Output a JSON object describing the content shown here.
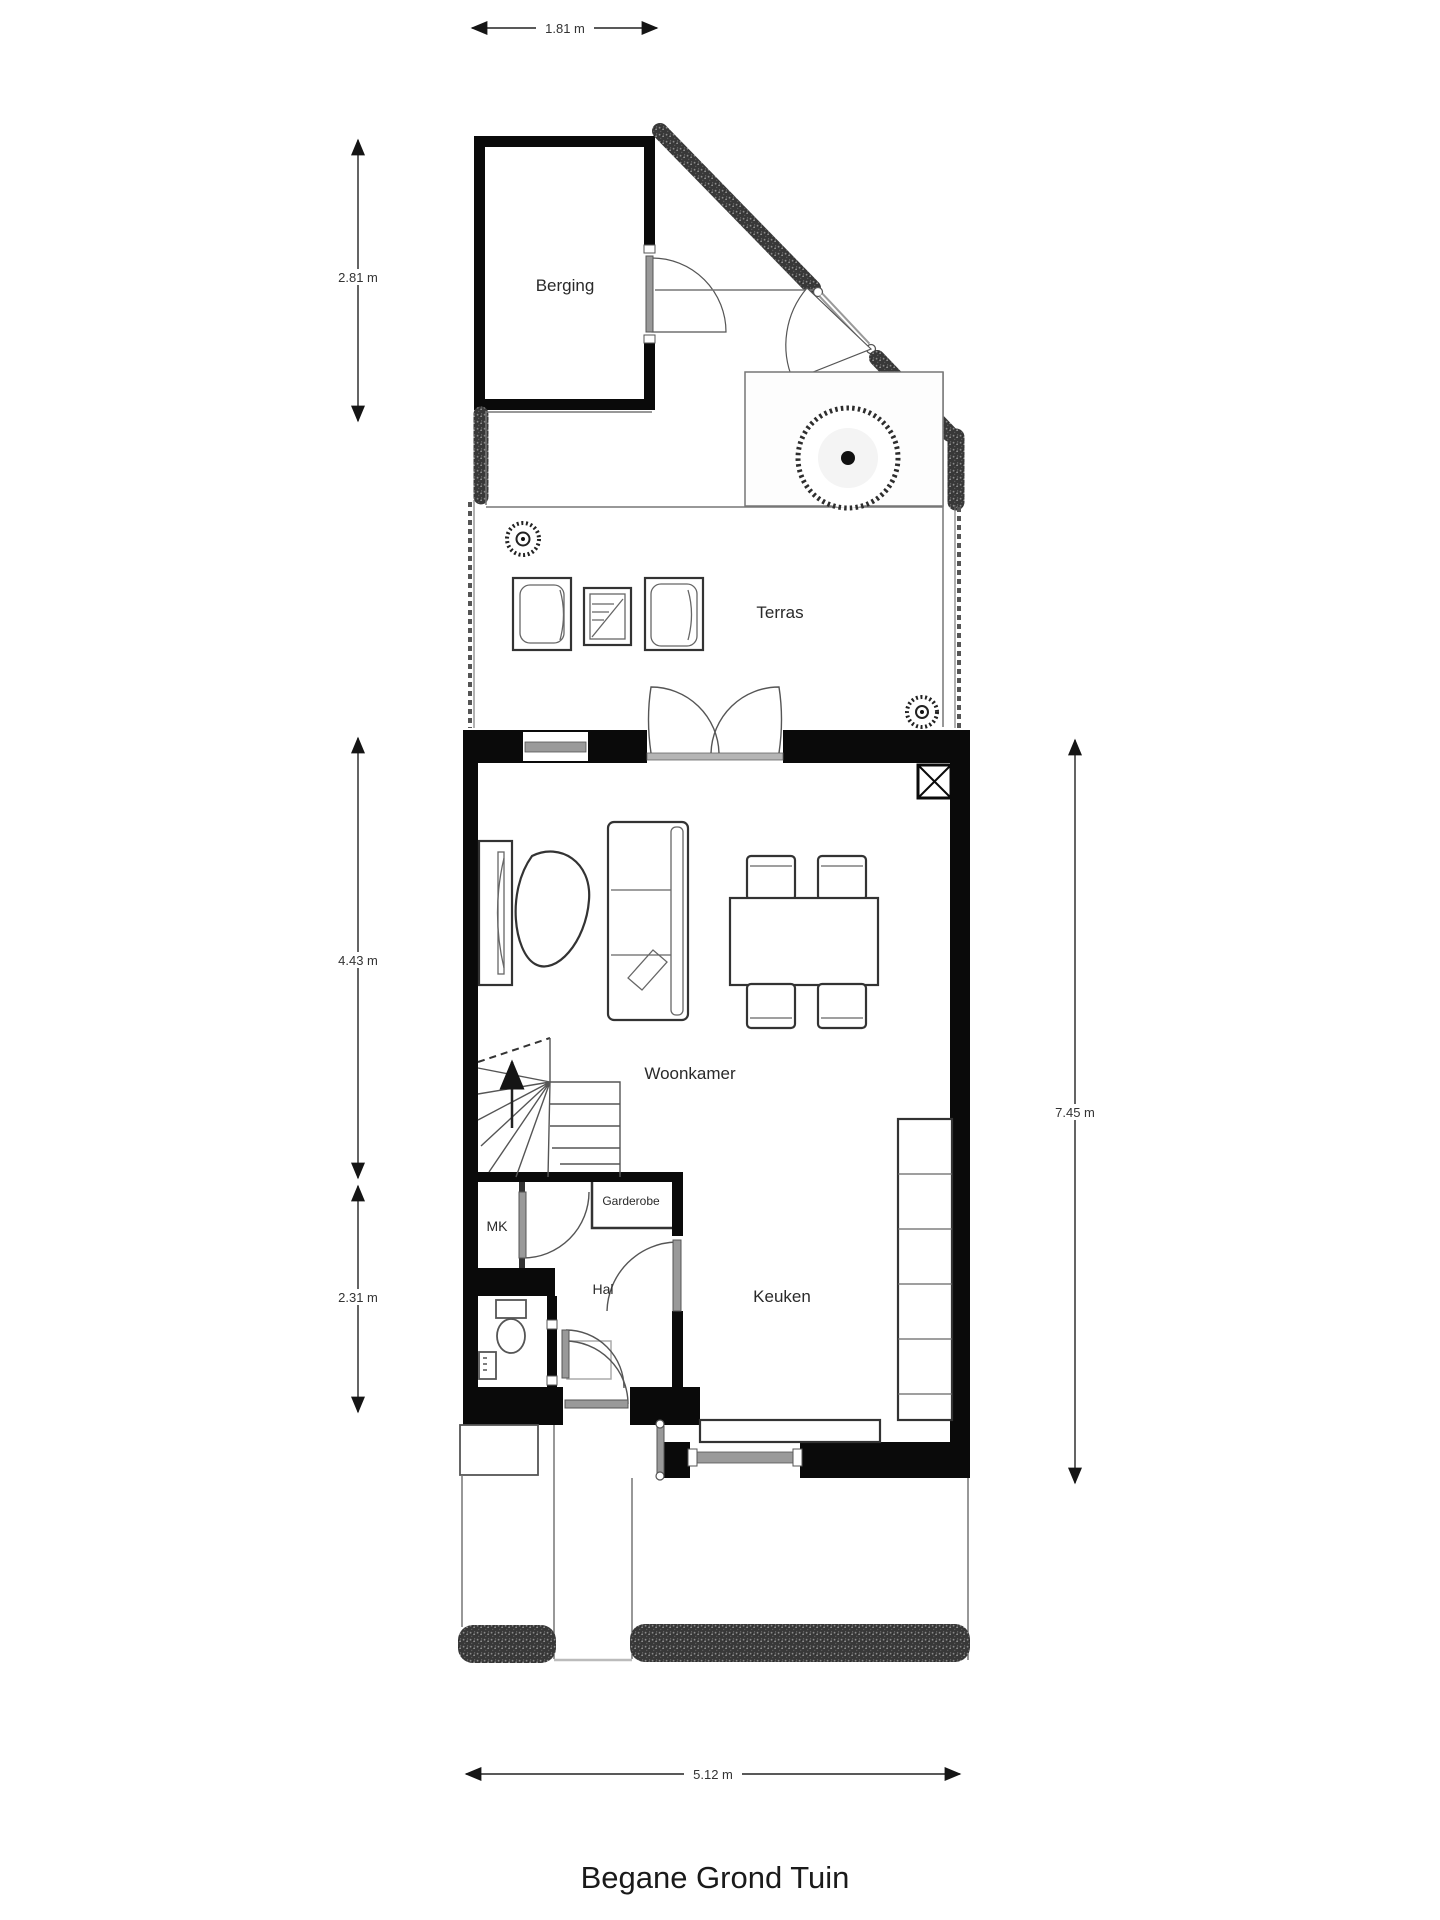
{
  "title": "Begane Grond Tuin",
  "rooms": {
    "berging": "Berging",
    "terras": "Terras",
    "woonkamer": "Woonkamer",
    "garderobe": "Garderobe",
    "mk": "MK",
    "hal": "Hal",
    "keuken": "Keuken"
  },
  "dimensions": {
    "top_width": "1.81 m",
    "berging_height": "2.81 m",
    "woonkamer_height": "4.43 m",
    "hal_height": "2.31 m",
    "house_height": "7.45 m",
    "house_width": "5.12 m"
  },
  "colors": {
    "wall": "#0a0a0a",
    "garden_wall_speckle": "#3a3a3a",
    "thin_line": "#777777",
    "door_leaf": "#999999",
    "text": "#222222",
    "background": "#ffffff"
  }
}
